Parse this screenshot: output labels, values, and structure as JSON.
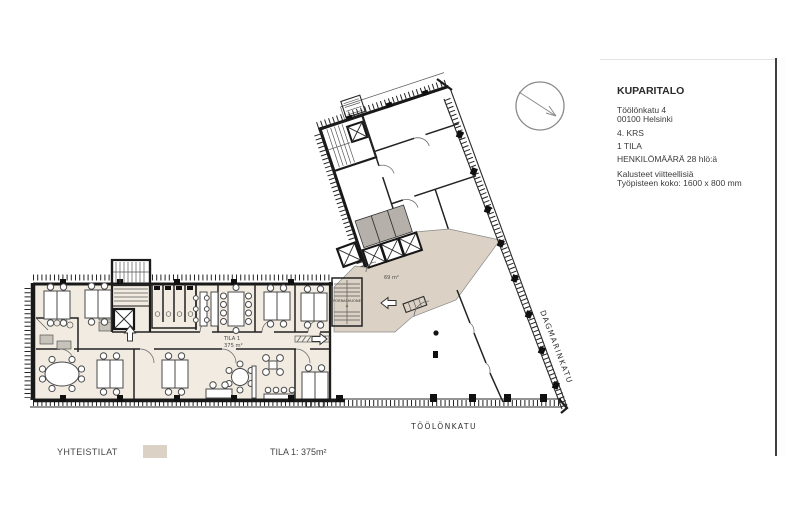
{
  "info_panel": {
    "title": "KUPARITALO",
    "address_line1": "Töölönkatu 4",
    "address_line2": "00100 Helsinki",
    "floor": "4. KRS",
    "space": "1 TILA",
    "occupancy": "HENKILÖMÄÄRÄ 28 hlö:ä",
    "note_line1": "Kalusteet viitteellisiä",
    "note_line2": "Työpisteen koko: 1600 x 800 mm"
  },
  "plan": {
    "labels": {
      "tila1_name": "TILA 1",
      "tila1_area": "375 m²",
      "lobby_area": "69 m²",
      "stairwell_name": "PORRASHUONE",
      "stairwell_letter": "A"
    },
    "streets": {
      "south": "TÖÖLÖNKATU",
      "east": "DAGMARINKATU"
    }
  },
  "legend": {
    "common_label": "YHTEISTILAT",
    "tila1_label": "TILA 1: 375m²"
  },
  "colors": {
    "common_fill": "#dbd1c4",
    "tila1_fill": "#f1ebe1",
    "wall": "#1b1b1b",
    "scrollbar_thumb": "#bdbdbd"
  }
}
